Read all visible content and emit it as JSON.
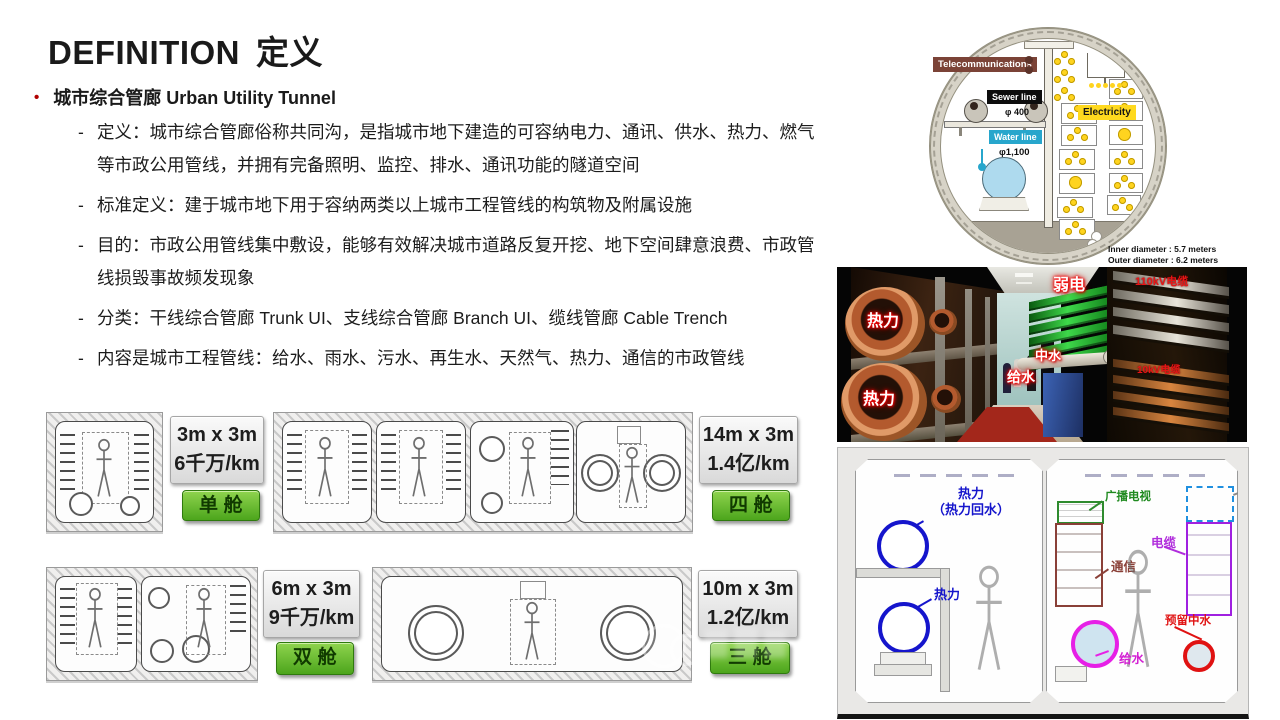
{
  "header": {
    "title_en": "DEFINITION",
    "title_cn": "定义"
  },
  "intro": {
    "bullet_glyph": "•",
    "bullet_label": "城市综合管廊 Urban Utility Tunnel",
    "dash": "-",
    "items": [
      "定义：城市综合管廊俗称共同沟，是指城市地下建造的可容纳电力、通讯、供水、热力、燃气等市政公用管线，并拥有完备照明、监控、排水、通讯功能的隧道空间",
      "标准定义：建于城市地下用于容纳两类以上城市工程管线的构筑物及附属设施",
      "目的：市政公用管线集中敷设，能够有效解决城市道路反复开挖、地下空间肆意浪费、市政管线损毁事故频发现象",
      "分类：干线综合管廊 Trunk UI、支线综合管廊 Branch UI、缆线管廊 Cable Trench",
      "内容是城市工程管线：给水、雨水、污水、再生水、天然气、热力、通信的市政管线"
    ]
  },
  "cost_cards": [
    {
      "size": "3m x 3m",
      "cost": "6千万/km",
      "cabin": "单舱"
    },
    {
      "size": "14m x 3m",
      "cost": "1.4亿/km",
      "cabin": "四舱"
    },
    {
      "size": "6m x 3m",
      "cost": "9千万/km",
      "cabin": "双舱"
    },
    {
      "size": "10m x 3m",
      "cost": "1.2亿/km",
      "cabin": "三舱"
    }
  ],
  "tunnel_diagram": {
    "telecom": "Telecommunications",
    "sewer_line": "Sewer line",
    "sewer_diameter": "φ 400",
    "water_line": "Water line",
    "water_diameter": "φ1,100",
    "electricity": "Electricity",
    "inner_diameter": "Inner diameter : 5.7 meters",
    "outer_diameter": "Outer diameter : 6.2 meters"
  },
  "corridor_photo": {
    "heat_label_upper": "热力",
    "heat_label_lower": "热力",
    "weak_current_label": "弱电",
    "reclaimed_water_label": "中水",
    "water_supply_label": "给水",
    "cable_110kv_label": "110kV电缆",
    "cable_10kv_label": "10kV电缆"
  },
  "section_drawings": {
    "left": {
      "heat_return_line1": "热力",
      "heat_return_line2": "（热力回水）",
      "heat_label": "热力"
    },
    "right": {
      "broadcast_tv": "广播电视",
      "cable": "电缆",
      "telecom": "通信",
      "reserved_reclaimed": "预留中水",
      "water_supply": "给水"
    }
  },
  "colors": {
    "accent_red": "#b00000",
    "cabin_green": "#4ca51c",
    "telecom_brown": "#7b4337",
    "water_blue": "#29a7cd",
    "electric_yellow": "#ffd91e",
    "label_blue": "#1515cc",
    "label_purple": "#b02ddc",
    "label_green": "#1f8a1f",
    "label_brown": "#8a4038",
    "label_red": "#e01212"
  }
}
